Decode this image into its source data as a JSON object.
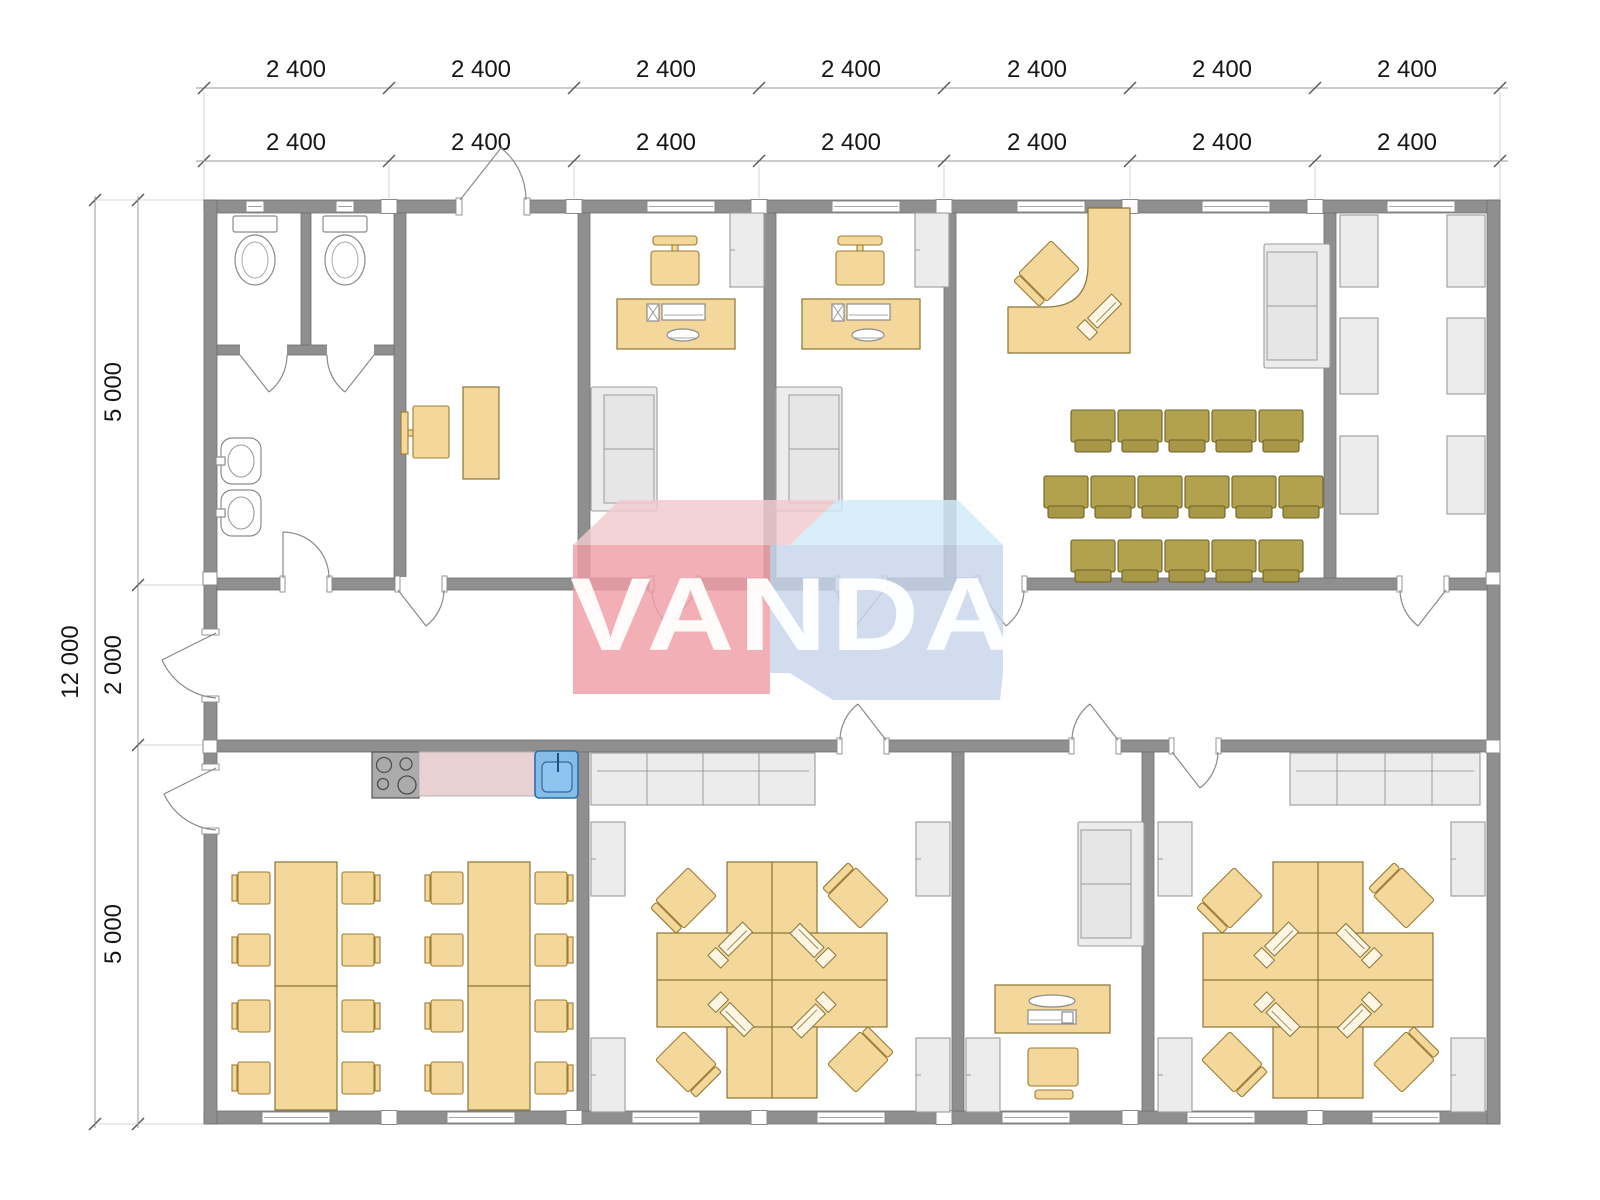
{
  "watermark": {
    "text": "VANDA"
  },
  "dimensions": {
    "top_row_1": [
      "2 400",
      "2 400",
      "2 400",
      "2 400",
      "2 400",
      "2 400",
      "2 400"
    ],
    "top_row_2": [
      "2 400",
      "2 400",
      "2 400",
      "2 400",
      "2 400",
      "2 400",
      "2 400"
    ],
    "left_total": "12 000",
    "left_segments": [
      "5 000",
      "2 000",
      "5 000"
    ]
  },
  "colors": {
    "wall_gray": "#8f8f8f",
    "furniture_tan": "#f3d79b",
    "chair_olive": "#b3a24d",
    "cabinet_gray": "#ececec",
    "counter_pink": "#e8d0d3",
    "sink_blue": "#85bde9",
    "stove_gray": "#ababab",
    "watermark_red": "#ef9da5",
    "watermark_pink": "#f2c9cd",
    "watermark_blue": "#c7d6ea",
    "watermark_light_blue": "#cfeaf7",
    "dimension_text": "#161616"
  }
}
